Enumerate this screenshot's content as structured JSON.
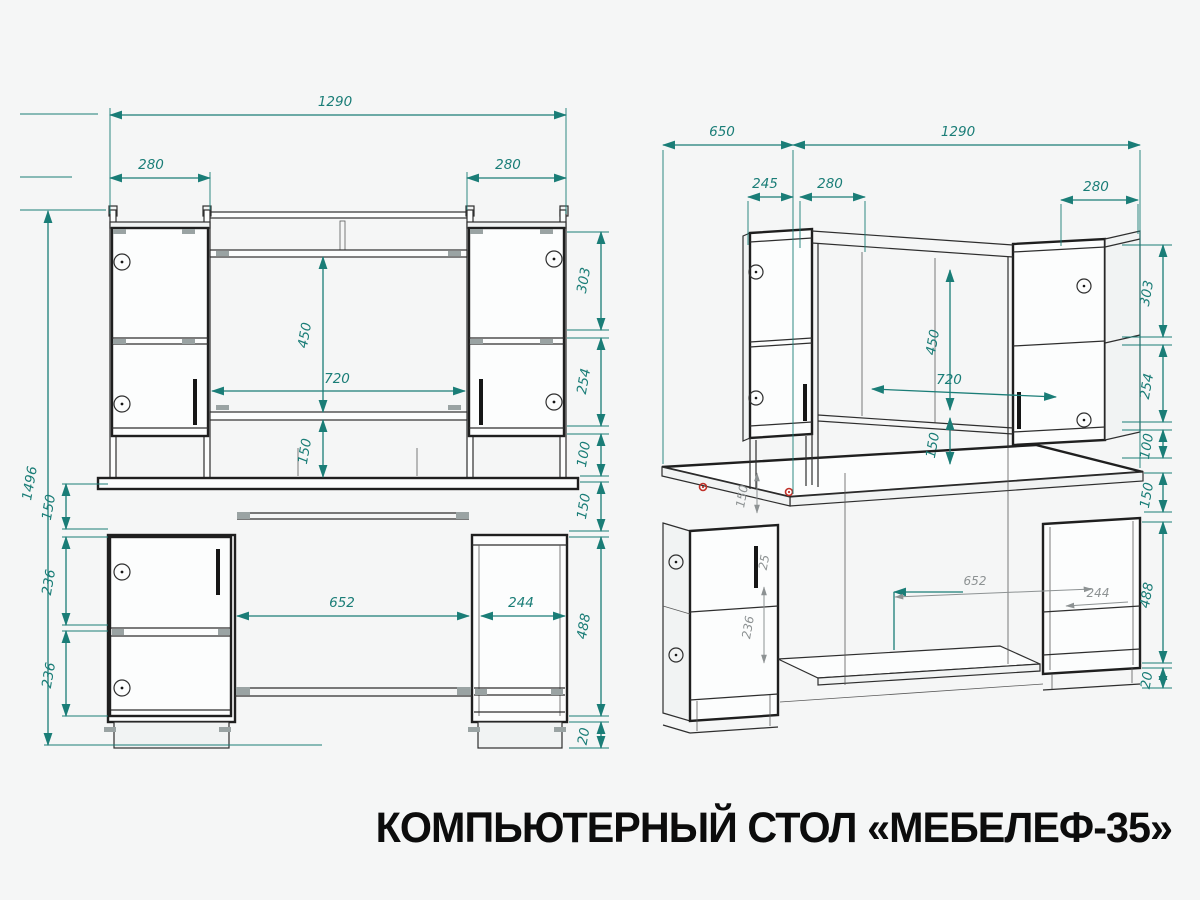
{
  "title": "КОМПЬЮТЕРНЫЙ СТОЛ «МЕБЕЛЕФ-35»",
  "colors": {
    "dimension_teal": "#1a7d77",
    "drawing_line": "#2e2e2e",
    "secondary_gray": "#8d9293",
    "accent_red": "#c03028",
    "background": "#f5f6f6",
    "title_text": "#0c0c0c"
  },
  "front_view": {
    "name": "front-elevation",
    "labels": {
      "w1290": "1290",
      "w280l": "280",
      "w280r": "280",
      "h1496": "1496",
      "apron150": "150",
      "p236a": "236",
      "p236b": "236",
      "n450": "450",
      "n720": "720",
      "n150": "150",
      "r303": "303",
      "r254": "254",
      "r100": "100",
      "r150": "150",
      "r488": "488",
      "r20": "20",
      "k652": "652",
      "p244": "244"
    }
  },
  "perspective_view": {
    "name": "isometric-view",
    "labels": {
      "d650": "650",
      "w1290": "1290",
      "d245": "245",
      "w280l": "280",
      "w280r": "280",
      "r303": "303",
      "r254": "254",
      "r100": "100",
      "r150": "150",
      "r488": "488",
      "r20": "20",
      "n450": "450",
      "n720": "720",
      "n150": "150",
      "g150": "150",
      "g236": "236",
      "g652": "652",
      "g244": "244",
      "g25": "25"
    }
  }
}
